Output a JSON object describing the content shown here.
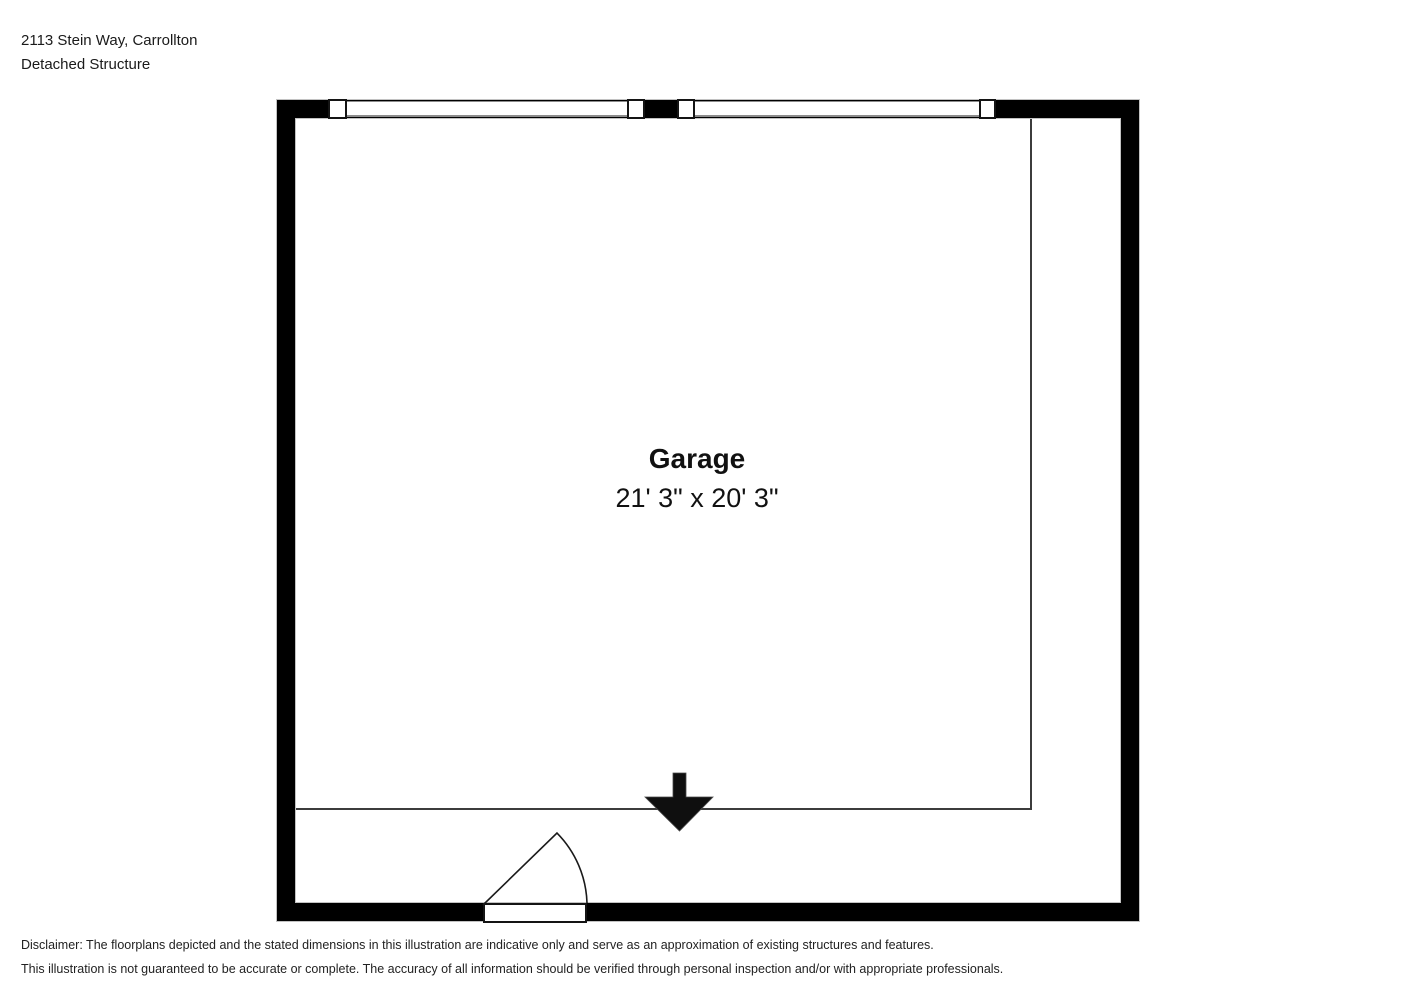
{
  "header": {
    "address": "2113 Stein Way, Carrollton",
    "subtitle": "Detached Structure"
  },
  "floorplan": {
    "room_label": "Garage",
    "room_dimensions": "21' 3\" x 20' 3\""
  },
  "disclaimer": {
    "line1": "Disclaimer: The floorplans depicted and the stated dimensions in this illustration are indicative only and serve as an approximation of existing structures and features.",
    "line2": "This illustration is not guaranteed to be accurate or complete. The accuracy of all information should be verified through personal inspection and/or with appropriate professionals."
  },
  "colors": {
    "wall": "#000000",
    "background": "#ffffff",
    "text": "#1a1a1a",
    "room_line": "#3c3c3c",
    "window_frame": "#8c8c8c"
  }
}
